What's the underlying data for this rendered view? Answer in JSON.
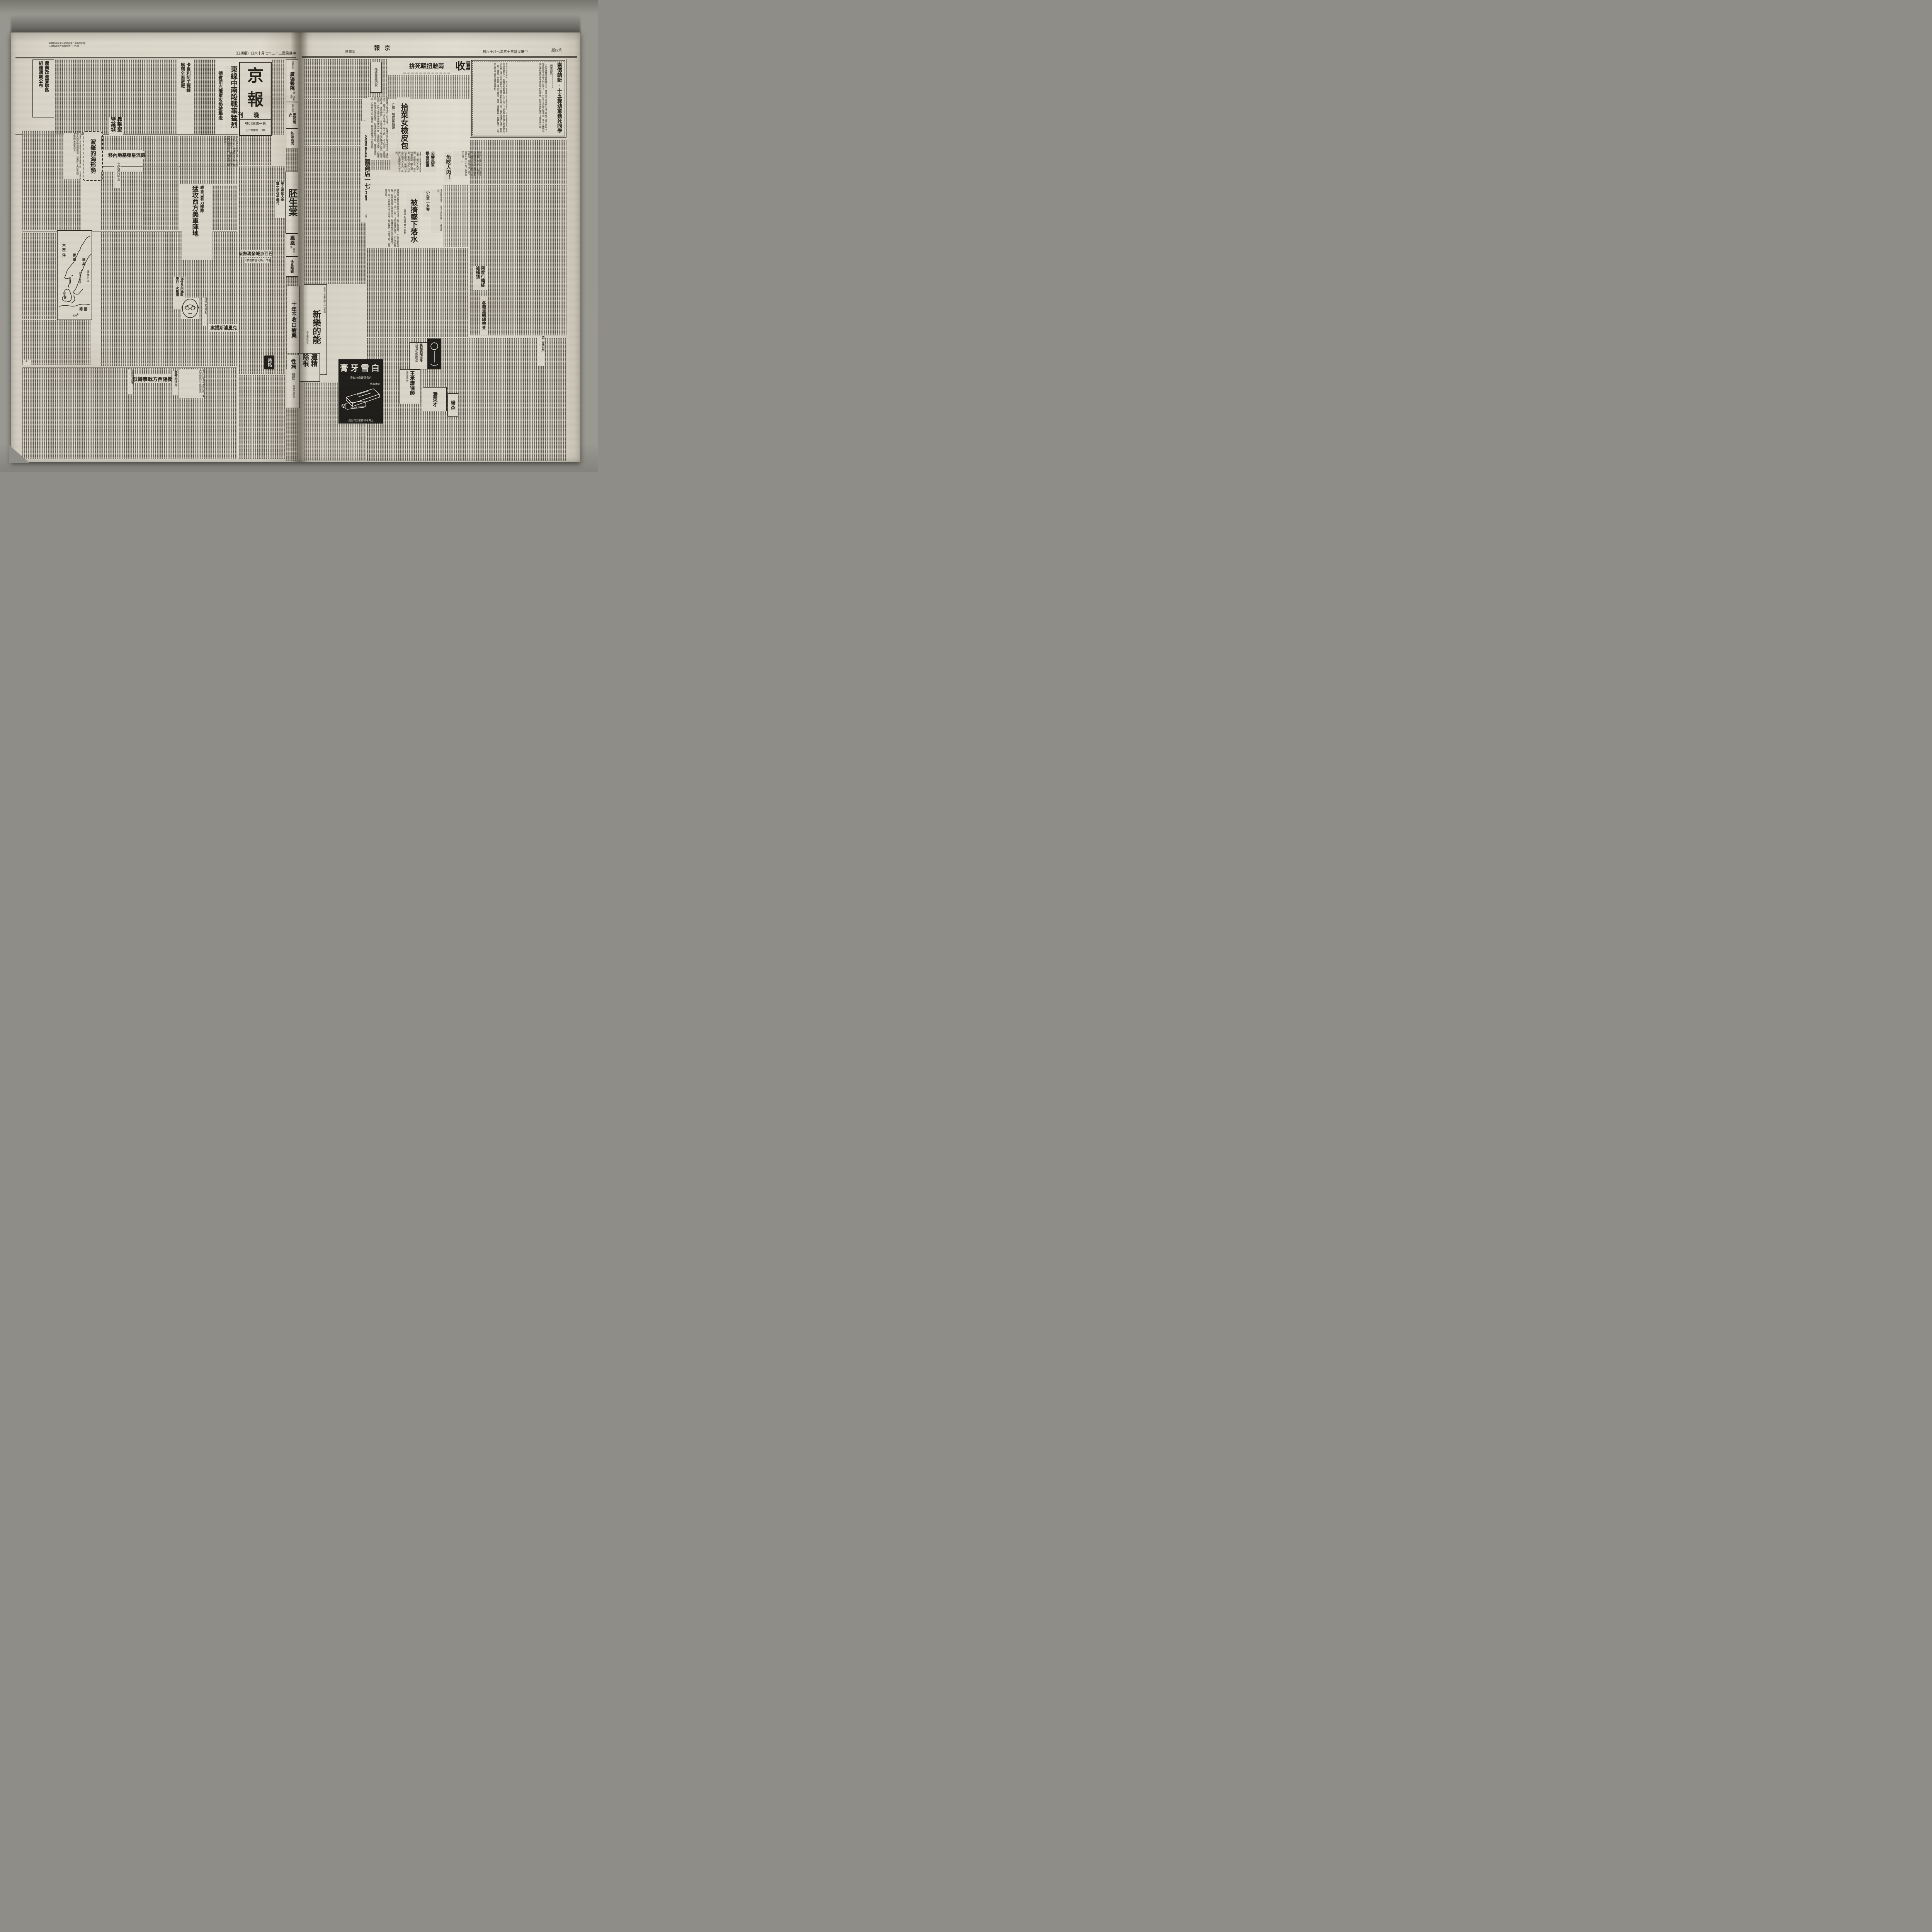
{
  "left": {
    "postal1": "中華郵政特准掛號認為第二類新聞紙類",
    "postal2": "江蘇郵政管理局執照第一〇九號",
    "date_line": "中華民國三十三年七月十六日（星期日）",
    "masthead": {
      "title_top": "京",
      "title_bottom": "報",
      "edition": "晚刊",
      "issue": "第一四三〇號",
      "price": "每日一張國幣二元"
    },
    "nongye": {
      "l1": "農業改進實驗區",
      "l2": "組織通則公布"
    },
    "kaleli": {
      "l1": "卡累利阿主戰線",
      "l2": "展開全面激戰"
    },
    "dongxian": {
      "headline": "東線中南段戰事猛烈",
      "subhead": "德賓斯克俄軍攻勢被擊退",
      "lede": "柏林十六日中央社電：據消息通訊社訊，德軍發言人稱：俄軍今夏攻勢，企圖由達爾諾波里突破德軍防線，我軍現已轉移陣地……"
    },
    "hongji": "轟擊聖特羅城",
    "deliu": "德流星彈基地內移",
    "tuli": "土仍堅持中立",
    "polo": {
      "title": "波羅的海形勢",
      "excerpt": "波羅的海在地理上也不僅是疆界線……它和蘇俄大陸有極端的環境，位置於三大陸之間……波羅的海是很容易……",
      "part_mark": "（上）"
    },
    "map": {
      "ocean": "大西洋",
      "sweden": "瑞典",
      "norway": "挪威",
      "denmark": "丹麥",
      "germany": "德國",
      "berlin": "柏林",
      "oslo": "奧斯陸",
      "stockholm": "斯德哥爾摩",
      "baltic": "波羅的海"
    },
    "weike": {
      "kicker": "威克日有力部隊",
      "headline": "猛攻西方美軍陣地"
    },
    "huabei": {
      "l1": "華北運動大會",
      "l2": "雙十節在平舉行"
    },
    "baowai": {
      "l1": "保外長與攝政",
      "l2": "舉行二次集議"
    },
    "baxi": {
      "headline": "巴西京城發現熱症",
      "subhead": "名曰『馬利亞特倫熱』"
    },
    "keli": {
      "headline": "克里浦斯提案",
      "kicker": "甘地表示反對"
    },
    "hengyang": {
      "kicker": "陝縣附近渝軍",
      "headline": "衡陽西方戰事轉烈",
      "subhead": "美使未決定",
      "lede": "十六日據上海美通社訊：美大使赫爾利氏由渝飛返……"
    },
    "shihua": "時話",
    "ads": {
      "guangde": {
        "note": "由滬移京",
        "name": "廣德醫院",
        "services": "痔·外科·花柳"
      },
      "aifu": {
        "note": "南京特約",
        "name": "愛弗雨衣"
      },
      "zimei": "姊妹商店",
      "peisheng": "胚生棠",
      "fenghuang": {
        "name": "鳳凰",
        "note": "一飛劇團"
      },
      "xuchang": "徐昌眼鏡"
    }
  },
  "right": {
    "header": {
      "weekday": "星期日",
      "paper": "京報",
      "date": "中華民國三十三年七月十六日",
      "page": "第四版"
    },
    "fushui": {
      "headline": "覆水重收",
      "subhead": "兩雌扭毆死拚"
    },
    "weizao": "偽造匯票領款",
    "weizhang": {
      "kicker": "取締物價委會裁定",
      "headline": "違章囤積罰商店一七五家",
      "end_mark": "◎"
    },
    "shicai": {
      "headline": "拾菜女檢皮包",
      "subhead": "弄得一場官司臨頭",
      "lede": "鹽城婦人楊張氏（四十歲），住本市山西路十號之五，夫已去世，膝下有一女名三十子（十二歲），母女相依，家中毫無恆產，靠縫紉度日。日前三十子在山西路地方拾菜，旋發覺地上有他人遺失之黑色皮包一隻，當即攜取返家，心頗喜悅，嗣被該管警察探悉，以張氏等拾物不報，顯係意圖侵占，乃將伊母女一同帶局，轉解首都地方法院法辦。"
    },
    "gongying": {
      "l1": "公營馬車",
      "l2": "提高票價",
      "lede": "本市公營馬車自添設以來，便利人民交通，成績甚佳，近以物價高漲，開支加增，車價乃自昨日起略予提高，新街口至山西路每人十元，新街口至康路每人十五元。"
    },
    "yuchi": {
      "headline": "魚吃人肉！",
      "lede": "通濟門外雙橋門附近藥局前河旁，昨上午十時許，河中突有浮屍一具順水飄來，經附近駐軍發覺，報告警局，飭役打撈上岸，該屍年約三十餘，身穿黑色小褂……"
    },
    "xiaohuoche": {
      "kicker": "小火車一女客",
      "headline": "被擠墜下落水",
      "subhead": "武定門附近昨晨一車禍",
      "lede": "邇來本京黃包車價亦告上漲，隨百物波動，一般市民均改乘小火車代步，故小火車上之乘客擁擠異常。近日天氣酷熱，各乘客均爭立於車門旁。昨晨車經武定門外鐵橋上時，有一立於車門旁之女客，被人擁擠，立足不穩，竟墜落水中。",
      "youyong": "今夏酷暑迫人，游泳池開放後，一番活躍矣。"
    },
    "essay": {
      "kicker": "天津通訊",
      "title": "索償蜻蜓·十五歲幼童勒死同學",
      "p1": "「你說這算是個什麼年月，連那乳毛未淨的小孩子都敢下毒手去殺人，簡直變成了個殺人的世界了！」一位老太婆聽人講述完一件十五歲的幼童以書包帶勒死十歲同學的新聞後，無限感慨的講出了這麼幾句話。",
      "p2": "尚未成年的時代，而他却能因為小小事故便殺人，這倒確實不是件簡單的社會事件了，也難怪他要感嘆人心不古了。這件事情的發生地點是在河北省天津市第六區界內一個荒僻的茶園之內，最初僅僅是在端午節前一日，發現了一具被人謀害的童屍，脖頸上還緊繫着一根書包帶，一定是生前被人勒斃身死棄屍的。"
    },
    "liangdu": "兩度行竊終被捕獲",
    "chejian": "各種車輛總檢查",
    "chen": {
      "l1": "晨起痰喘很多",
      "l2": "是否初期肺病"
    },
    "wang": {
      "name": "王承謙律師",
      "note": "南京事務所"
    },
    "baixue": {
      "name": "白雪牙膏",
      "slogan": "白雪牙膏齒白如雪",
      "avail": "到處有售",
      "brand_en": "WHITE SNOW",
      "company": "上海永和實業公司出品"
    },
    "pan": "潘英才",
    "yang": "楊杰",
    "qu": "第二區公所",
    "ads": {
      "xinle": {
        "name": "新樂的能",
        "line1": "男用白色藥片解決一切淋病",
        "line2": "各大藥房均售"
      },
      "yijing": {
        "l1": "遺精",
        "l2": "除根"
      },
      "shinian": "十年不收口瘡藥",
      "xingbing": {
        "name": "性病",
        "name2": "醫院",
        "services": "電療淋病花柳"
      }
    }
  }
}
